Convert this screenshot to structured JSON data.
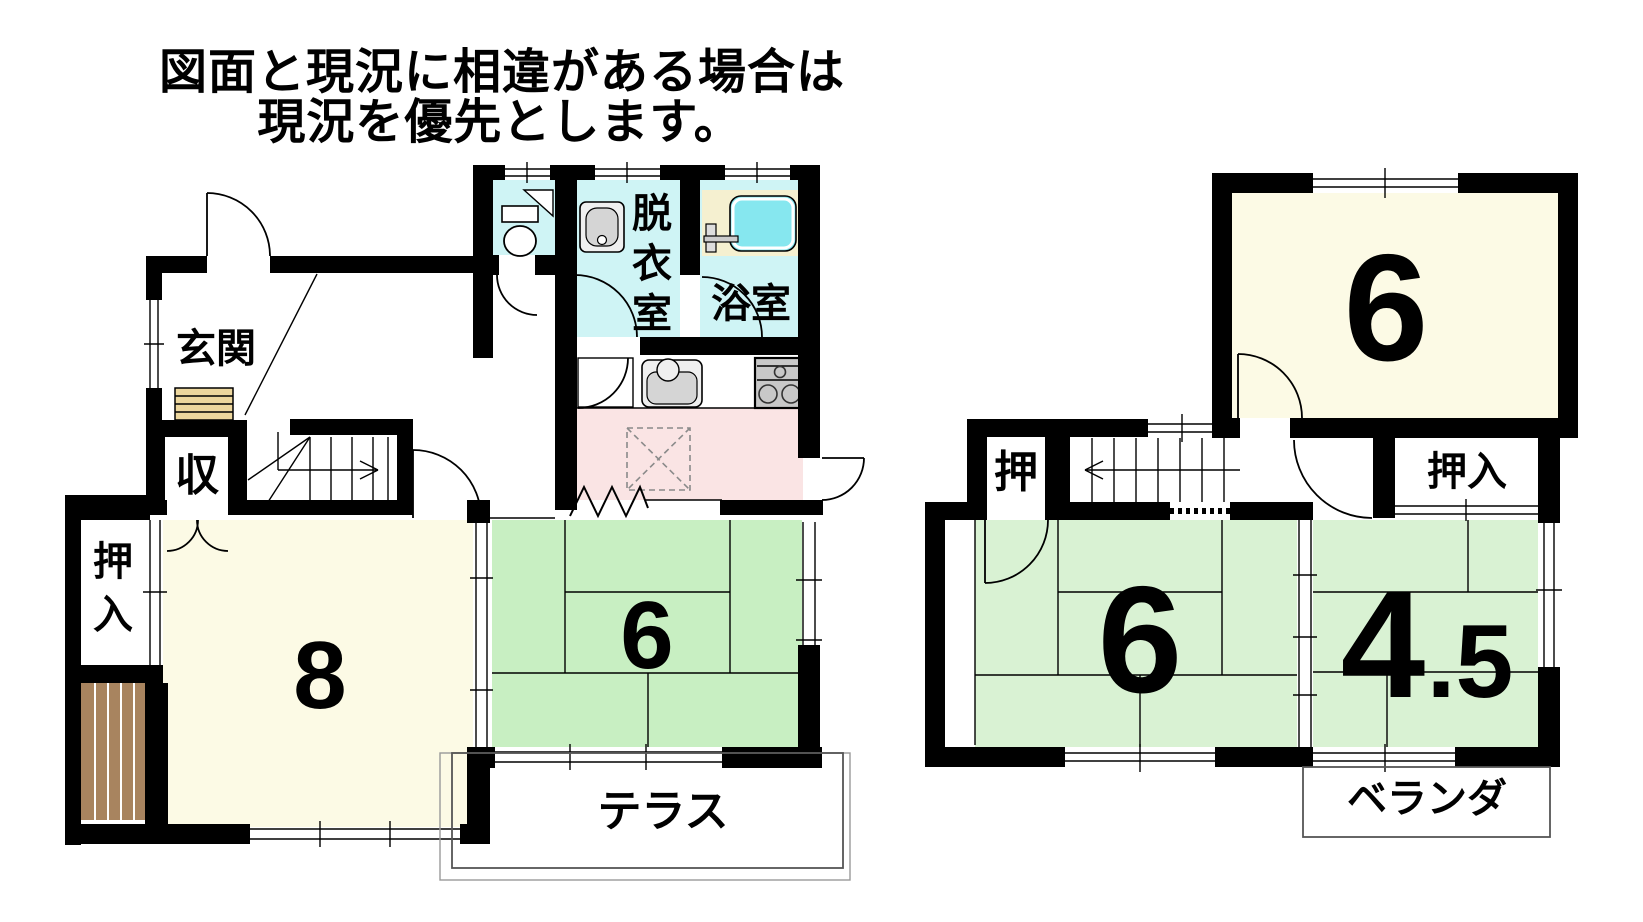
{
  "header": {
    "line1": "図面と現況に相違がある場合は",
    "line2": "現況を優先とします。"
  },
  "floor1": {
    "entrance_label": "玄関",
    "storage_label": "収",
    "closet_label": "押入",
    "room8_size": "8",
    "room6_size": "6",
    "dressing_label": "脱衣室",
    "bath_label": "浴室",
    "terrace_label": "テラス"
  },
  "floor2": {
    "room6_upper_size": "6",
    "closet_small_label": "押",
    "closet_label": "押入",
    "room6_size": "6",
    "room45_size": "4",
    "room45_decimal": ".5",
    "veranda_label": "ベランダ"
  },
  "colors": {
    "wall": "#000000",
    "cream_room": "#FCFAE5",
    "green_room_1f": "#C8EFC2",
    "green_room_2f": "#D9F2D3",
    "cyan_room": "#CFF4F5",
    "bathtub": "#86E7EF",
    "tub_deck": "#F5F0D0",
    "kitchen_pink": "#FAE4E4",
    "step_tan": "#EDD79E",
    "wood_brown": "#A8845F",
    "fixture_light": "#EFEFEF",
    "fixture_mid": "#D5D5D5",
    "stove_gray": "#C8C8C8"
  }
}
